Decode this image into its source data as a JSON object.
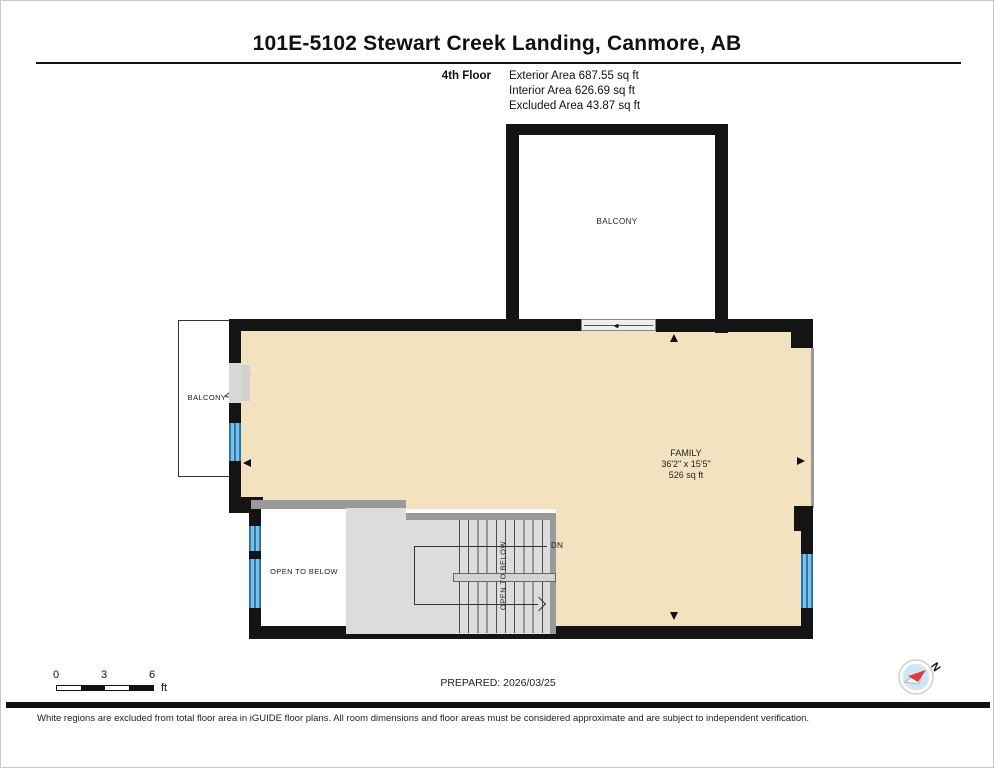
{
  "header": {
    "title": "101E-5102 Stewart Creek Landing, Canmore, AB",
    "floor_label": "4th Floor",
    "areas": {
      "exterior": "Exterior Area 687.55 sq ft",
      "interior": "Interior Area 626.69 sq ft",
      "excluded": "Excluded Area 43.87 sq ft"
    }
  },
  "plan": {
    "balcony_top_label": "BALCONY",
    "balcony_left_label": "BALCONY",
    "family": {
      "name": "FAMILY",
      "dims": "36'2\" x 15'5\"",
      "area": "526 sq ft"
    },
    "open_to_below_label": "OPEN TO BELOW",
    "stair_open_to_below_label": "OPEN TO BELOW",
    "down_label": "DN"
  },
  "scale_bar": {
    "tick_0": "0",
    "tick_3": "3",
    "tick_6": "6",
    "unit": "ft"
  },
  "prepared_label": "PREPARED: 2026/03/25",
  "compass_label": "N",
  "disclaimer": "White regions are excluded from total floor area in iGUIDE floor plans. All room dimensions and floor areas must be considered approximate and are subject to independent verification.",
  "colors": {
    "floor_fill": "#f3e2c0",
    "wall": "#141414",
    "stair_fill": "#dcdcdc",
    "window_blue": "#5aa9d6",
    "door_gray": "#d8d8d8",
    "compass_red": "#e03a3c",
    "compass_blue": "#cfe7f4"
  }
}
